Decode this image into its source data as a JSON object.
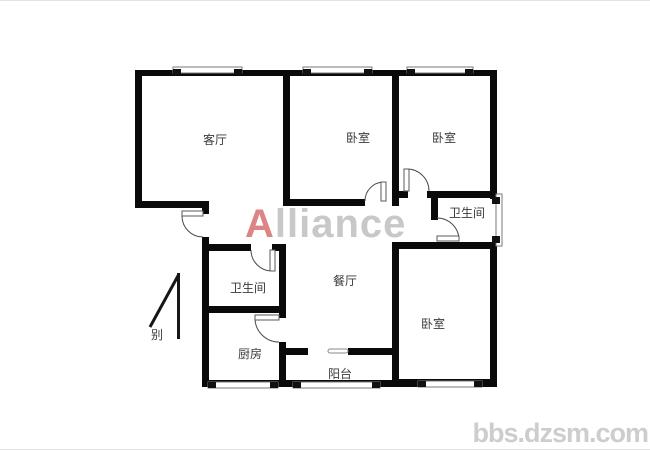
{
  "watermark": {
    "brand_first_letter": "A",
    "brand_rest": "lliance",
    "site": "bbs.dzsm.com"
  },
  "compass": {
    "label": "别"
  },
  "rooms": {
    "living_room": {
      "label": "客厅"
    },
    "bedroom_top_middle": {
      "label": "卧室"
    },
    "bedroom_top_right": {
      "label": "卧室"
    },
    "bathroom_upper_right": {
      "label": "卫生间"
    },
    "dining_room": {
      "label": "餐厅"
    },
    "bathroom_left": {
      "label": "卫生间"
    },
    "kitchen": {
      "label": "厨房"
    },
    "balcony": {
      "label": "阳台"
    },
    "bedroom_bottom_right": {
      "label": "卧室"
    }
  },
  "colors": {
    "wall": "#0a0a0a",
    "room_label": "#3a3a3a",
    "watermark_red": "#dd8484",
    "watermark_gray": "#c8c8c8",
    "site_watermark": "#cdcdcd"
  }
}
